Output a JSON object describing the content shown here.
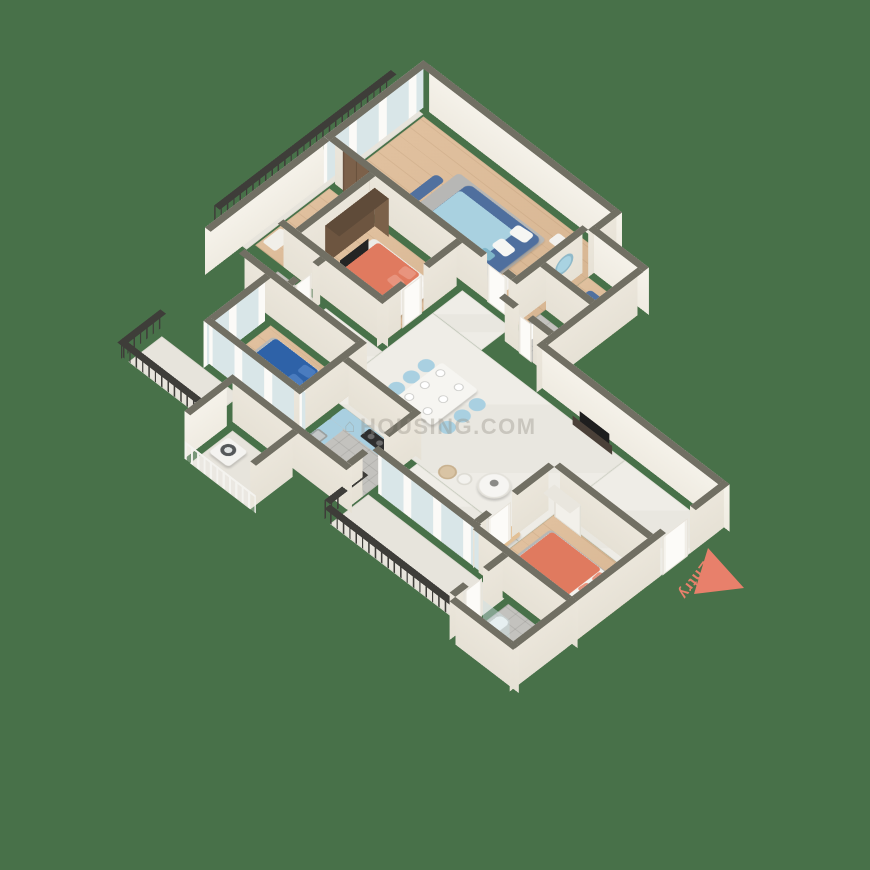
{
  "scene": {
    "kind": "isometric-3d-floor-plan-render",
    "background_color": "#487149",
    "watermark": {
      "icon": "⌂",
      "text": "HOUSING.COM"
    },
    "entry_marker": {
      "label": "Entry",
      "color": "#e8806b",
      "shape": "triangle-arrow"
    }
  },
  "palette": {
    "wall_cap": "#716f63",
    "wall_exterior": "#f4f1e9",
    "wall_interior": "#ece7dc",
    "wood_floor": "#dcbc9a",
    "marble_floor": "#edebe4",
    "bath_tile": "#c3c2be",
    "iron_railing": "#3e3d39",
    "coral_bed": "#e07a5f",
    "denim_bed": "#4f6f9e",
    "navy_bed": "#2e62a8",
    "light_blue": "#a9d0e1",
    "sofa_beige": "#e2c095",
    "wardrobe_brown": "#7b6149"
  },
  "rooms": [
    {
      "name": "bedroom-top-right",
      "floor": "wood",
      "furniture": [
        "denim-double-bed",
        "light-blue-duvet",
        "nightstands",
        "round-mirror",
        "bench",
        "gray-rug"
      ]
    },
    {
      "name": "master-bedroom",
      "floor": "wood",
      "furniture": [
        "coral-double-bed",
        "brown-wardrobe",
        "brown-nightstands",
        "tv-panel",
        "white-rug"
      ]
    },
    {
      "name": "bedroom-left",
      "floor": "wood",
      "furniture": [
        "navy-double-bed",
        "white-frame",
        "tv-console",
        "gray-rug"
      ]
    },
    {
      "name": "bedroom-bottom",
      "floor": "wood",
      "furniture": [
        "coral-double-bed",
        "white-wardrobe",
        "nightstand",
        "gray-rug"
      ]
    },
    {
      "name": "living-room",
      "floor": "marble",
      "furniture": [
        "beige-l-sofa",
        "round-coffee-table",
        "tv-console",
        "papasan-chair",
        "side-table"
      ]
    },
    {
      "name": "dining-area",
      "floor": "marble",
      "furniture": [
        "white-dining-table",
        "six-light-blue-chairs",
        "six-place-settings"
      ]
    },
    {
      "name": "kitchen",
      "floor": "tile",
      "furniture": [
        "light-blue-counters",
        "hob",
        "sink",
        "fridge"
      ]
    },
    {
      "name": "utility-balcony",
      "floor": "stone",
      "furniture": [
        "washing-machine",
        "white-railing"
      ]
    },
    {
      "name": "bathroom-top",
      "floor": "tile",
      "furniture": [
        "toilet",
        "shower"
      ]
    },
    {
      "name": "bathroom-middle",
      "floor": "tile",
      "furniture": [
        "toilet",
        "washbasin"
      ]
    },
    {
      "name": "bathroom-bottom",
      "floor": "tile",
      "furniture": [
        "toilet",
        "washbasin",
        "glass-shower"
      ]
    },
    {
      "name": "balcony-northwest",
      "floor": "stone",
      "furniture": [
        "iron-railing"
      ]
    },
    {
      "name": "balcony-left",
      "floor": "stone",
      "furniture": [
        "iron-railing"
      ]
    },
    {
      "name": "balcony-bottom",
      "floor": "stone",
      "furniture": [
        "iron-railing"
      ]
    },
    {
      "name": "foyer",
      "floor": "wood",
      "furniture": [
        "brown-double-entrance-door",
        "shoe-cabinet"
      ]
    }
  ]
}
